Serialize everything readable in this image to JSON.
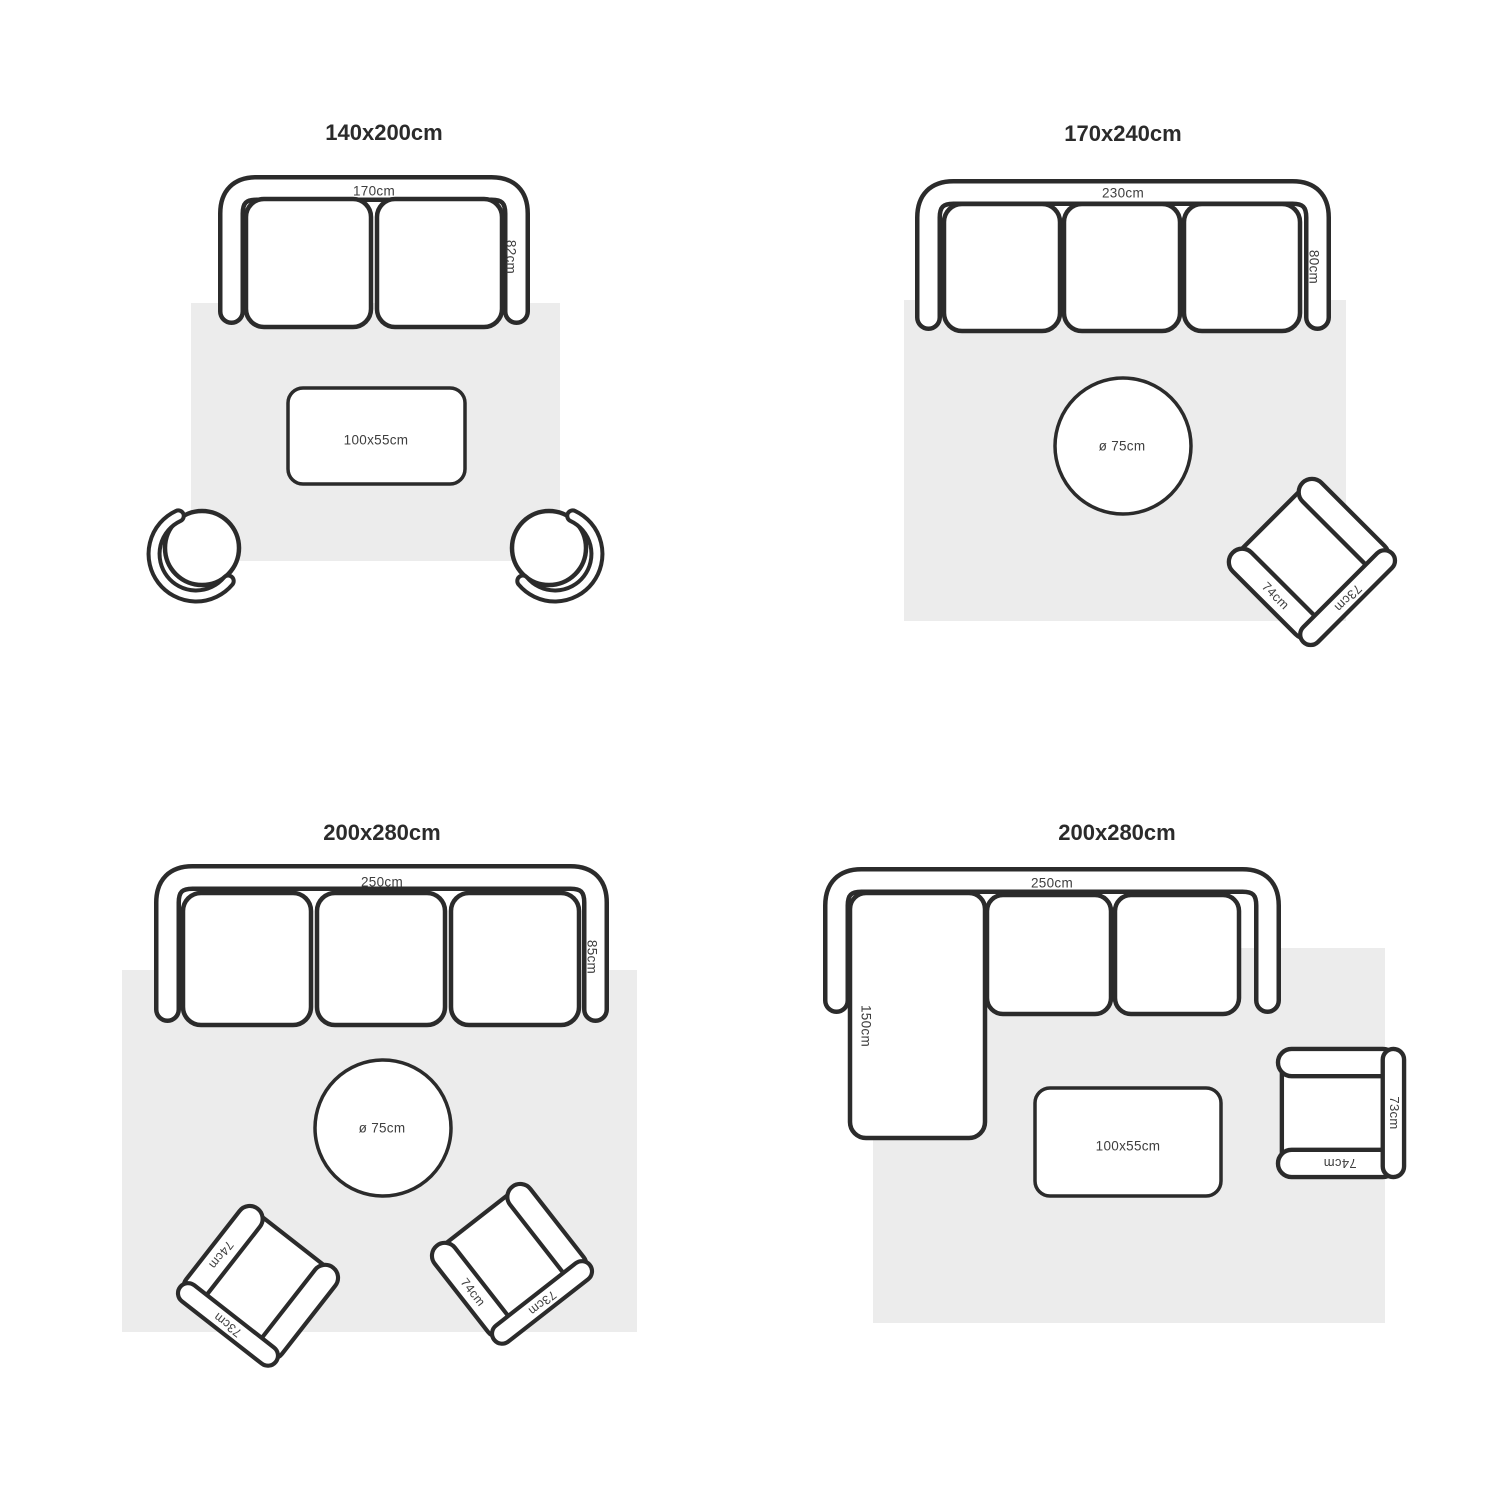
{
  "colors": {
    "outline": "#2b2b2b",
    "rug": "#ececec",
    "label": "#3e3e3e",
    "title": "#2b2b2b",
    "furniture_fill": "#ffffff",
    "background": "#ffffff"
  },
  "panels": [
    {
      "title": "140x200cm",
      "sofa_width": "170cm",
      "sofa_depth": "82cm",
      "table_label": "100x55cm"
    },
    {
      "title": "170x240cm",
      "sofa_width": "230cm",
      "sofa_depth": "80cm",
      "table_label": "ø 75cm",
      "armchair": {
        "arm": "74cm",
        "back": "73cm"
      }
    },
    {
      "title": "200x280cm",
      "sofa_width": "250cm",
      "sofa_depth": "85cm",
      "table_label": "ø 75cm",
      "armchair_left": {
        "arm": "74cm",
        "back": "73cm"
      },
      "armchair_right": {
        "arm": "74cm",
        "back": "73cm"
      }
    },
    {
      "title": "200x280cm",
      "sofa_width": "250cm",
      "chaise_length": "150cm",
      "table_label": "100x55cm",
      "armchair": {
        "arm": "74cm",
        "back": "73cm"
      }
    }
  ]
}
